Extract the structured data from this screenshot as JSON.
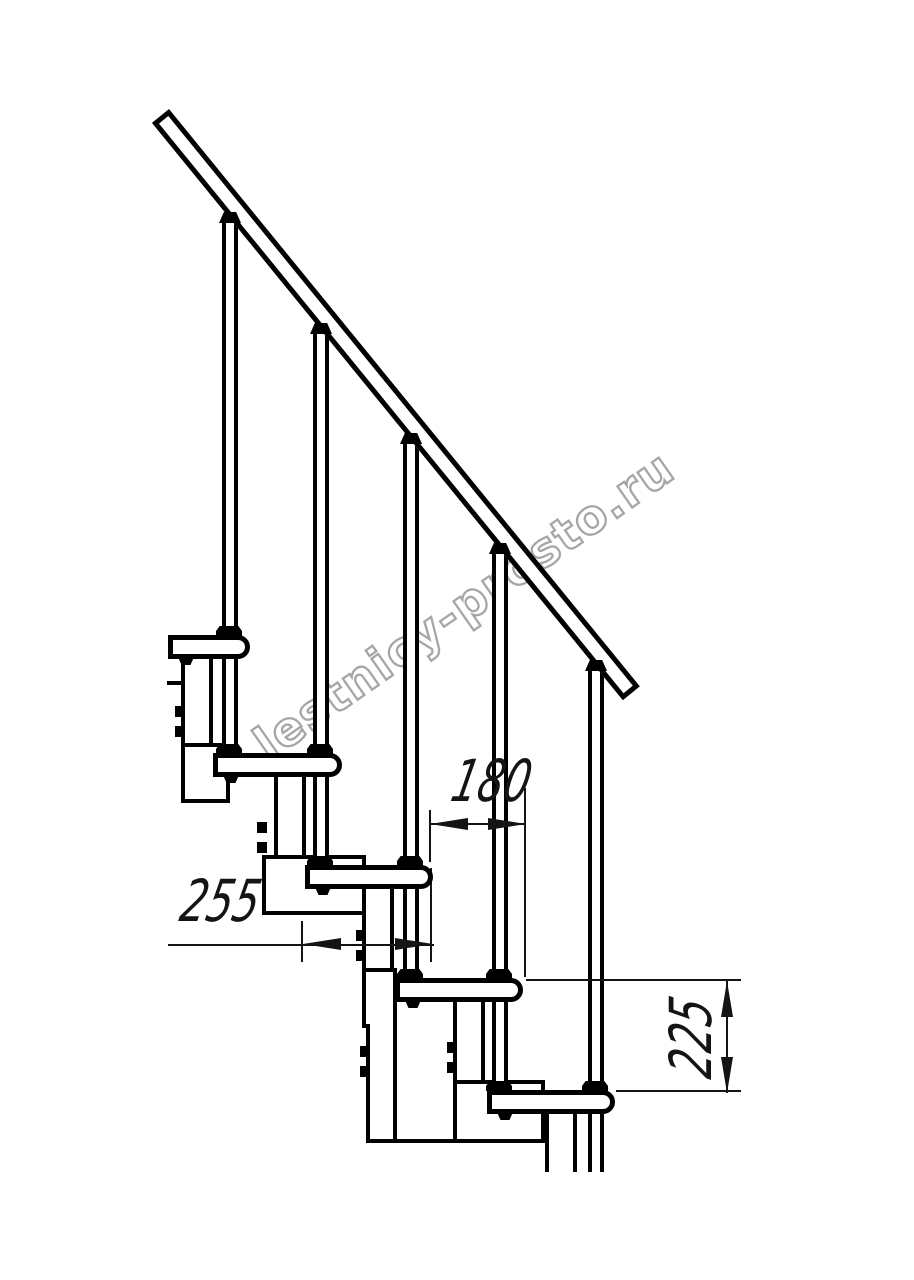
{
  "drawing": {
    "title": "Modular staircase fragment, side view (technical drawing)",
    "units": "mm",
    "dimensions": {
      "step_run": "180",
      "tread_depth": "255",
      "step_rise": "225"
    },
    "parts": {
      "treads_visible": 5,
      "balusters_visible": 5,
      "handrail": "inclined handrail, top left to bottom right"
    },
    "watermark": {
      "text": "lestnicy-prosto.ru",
      "color": "#a6a6a6"
    },
    "colors": {
      "line": "#000000",
      "dimension": "#141414",
      "background": "#ffffff"
    }
  }
}
